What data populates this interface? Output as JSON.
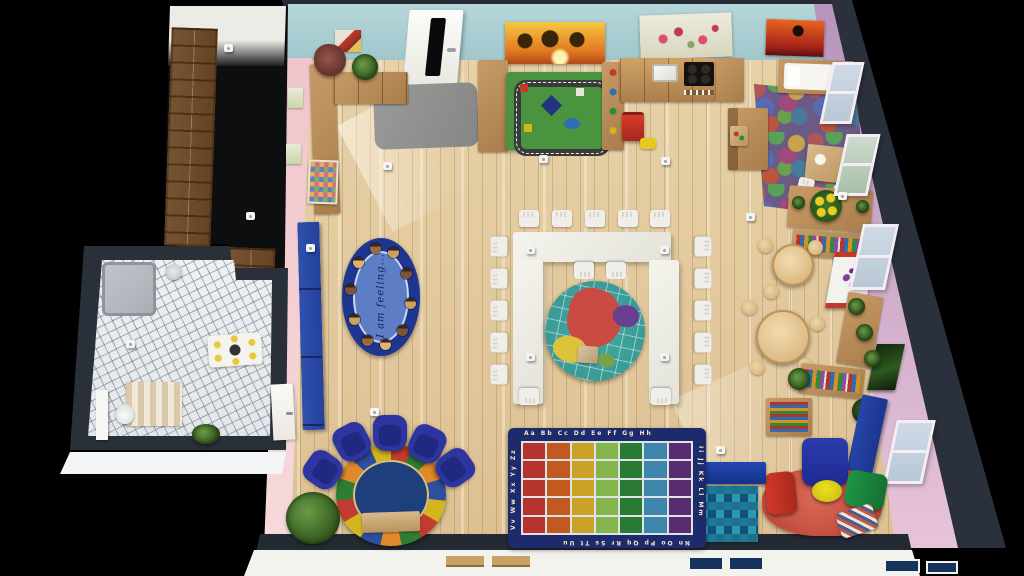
{
  "scene": {
    "description": "3D top-down floor plan render of a kindergarten classroom with cloakroom and bathroom",
    "background_color": "#000000"
  },
  "palette": {
    "floor_wood": "#e0c99f",
    "wall_top_teal": "#a9ced3",
    "wall_left_pink": "#f2cbd1",
    "wall_right_purple": "#c4a0c9",
    "wall_dark": "#2b313c",
    "exterior_white": "#f3f3ee",
    "furniture_wood": "#bf9563",
    "accent_navy": "#1e3fa0"
  },
  "rooms": {
    "classroom": "classroom",
    "cloakroom": "cloakroom with lockers",
    "bathroom": "bathroom with tiled floor"
  },
  "classroom": {
    "feelings_rug": {
      "text": "I am feeling...",
      "border_color": "#1e3690",
      "center_color": "#5d7dc4",
      "faces": 10
    },
    "alphabet_rug": {
      "letters_top": "Aa Bb Cc Dd Ee Ff Gg Hh",
      "letters_right": "Ii Jj Kk Ll Mm",
      "letters_bottom": "Nn Oo Pp Qq Rr Ss Tt Uu",
      "letters_left": "Vv Ww Xx Yy Zz",
      "border_color": "#1d2a6b",
      "column_colors": [
        "#b5342b",
        "#c2591e",
        "#c9a226",
        "#84b44c",
        "#2b7a34",
        "#3d86a9",
        "#582c6e"
      ],
      "rows": 5,
      "columns": 7
    },
    "paintings": [
      {
        "name": "palm-trees-sunset"
      },
      {
        "name": "floral-watercolor"
      },
      {
        "name": "savanna-sunset"
      },
      {
        "name": "hearts-poster"
      }
    ],
    "furniture": [
      "entry-door",
      "gray-entry-mat",
      "play-kitchen",
      "toy-shelf",
      "road-play-rug",
      "doll-bed",
      "puzzle-mat",
      "u-shaped-table",
      "white-chairs",
      "world-map-rug",
      "round-tables",
      "easel",
      "book-displays",
      "reading-corner-foam-seats",
      "red-rug",
      "blue-benches",
      "circle-time-rug",
      "blue-armchairs",
      "rainbow-alphabet-rug",
      "block-table",
      "plants",
      "ceiling-lamps"
    ]
  },
  "bathroom": {
    "fixtures": [
      "shower",
      "sink",
      "toilet",
      "changing-mat",
      "striped-rug"
    ]
  },
  "cloakroom": {
    "fixtures": [
      "locker-cubbies"
    ]
  }
}
